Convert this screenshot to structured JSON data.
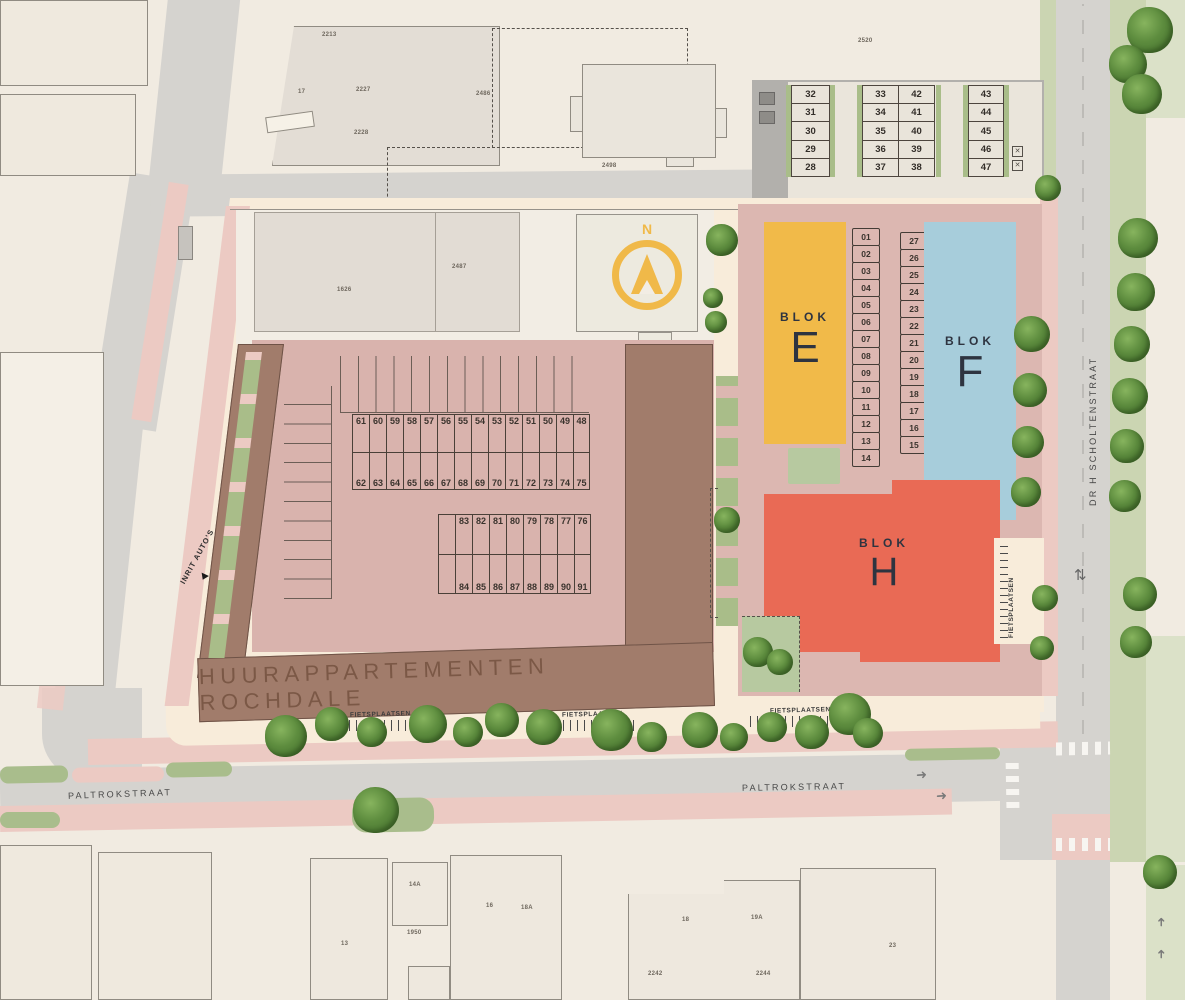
{
  "labels": {
    "rochdale": "HUURAPPARTEMENTEN ROCHDALE",
    "blok": "BLOK",
    "blok_e": "E",
    "blok_f": "F",
    "blok_h": "H",
    "inrit_autos": "INRIT AUTO'S",
    "fietsplaatsen": "FIETSPLAATSEN",
    "paltrokstraat": "PALTROKSTRAAT",
    "scholtenstraat": "DR H SCHOLTENSTRAAT",
    "north": "N"
  },
  "parking": {
    "ne_col1": [
      "32",
      "31",
      "30",
      "29",
      "28"
    ],
    "ne_col2": [
      "33",
      "34",
      "35",
      "36",
      "37"
    ],
    "ne_col3": [
      "42",
      "41",
      "40",
      "39",
      "38"
    ],
    "ne_col4": [
      "43",
      "44",
      "45",
      "46",
      "47"
    ],
    "p_row_left": [
      "P",
      "P",
      "P"
    ],
    "p_row_right": [
      "P",
      "P",
      "P"
    ],
    "center_left": [
      "01",
      "02",
      "03",
      "04",
      "05",
      "06",
      "07",
      "08",
      "09",
      "10",
      "11",
      "12",
      "13",
      "14"
    ],
    "center_right": [
      "27",
      "26",
      "25",
      "24",
      "23",
      "22",
      "21",
      "20",
      "19",
      "18",
      "17",
      "16",
      "15"
    ],
    "court_row1": [
      "61",
      "60",
      "59",
      "58",
      "57",
      "56",
      "55",
      "54",
      "53",
      "52",
      "51",
      "50",
      "49",
      "48"
    ],
    "court_row2": [
      "62",
      "63",
      "64",
      "65",
      "66",
      "67",
      "68",
      "69",
      "70",
      "71",
      "72",
      "73",
      "74",
      "75"
    ],
    "court_row3": [
      "",
      "83",
      "82",
      "81",
      "80",
      "79",
      "78",
      "77",
      "76"
    ],
    "court_row4": [
      "",
      "84",
      "85",
      "86",
      "87",
      "88",
      "89",
      "90",
      "91"
    ]
  },
  "parcels": {
    "n2213": "2213",
    "n17": "17",
    "n2227": "2227",
    "n2228": "2228",
    "n2486": "2486",
    "n2498": "2498",
    "n2520": "2520",
    "n1626": "1626",
    "n2487": "2487"
  },
  "south_parcels": {
    "p13": "13",
    "p14a": "14A",
    "p1950": "1950",
    "p16": "16",
    "p18a": "18A",
    "p18": "18",
    "p19a": "19A",
    "p2242": "2242",
    "p2244": "2244",
    "p23": "23"
  },
  "symbols": {
    "x": "✕",
    "arrow": "➜",
    "updown": "⇅"
  },
  "colors": {
    "road": "#d5d3cf",
    "roaddark": "#b2b0ac",
    "sidewalk": "#f8ecda",
    "lane": "#eccac3",
    "zone": "#dcb7b1",
    "court": "#d9b3ad",
    "brown": "#a17c6b",
    "blokE": "#f1ba49",
    "blokF": "#a7cddb",
    "blokH": "#e96a55",
    "verge": "#cbd5b2",
    "hedge": "#a9bd89",
    "patch": "#b7c9a0",
    "compass": "#f0b949"
  }
}
